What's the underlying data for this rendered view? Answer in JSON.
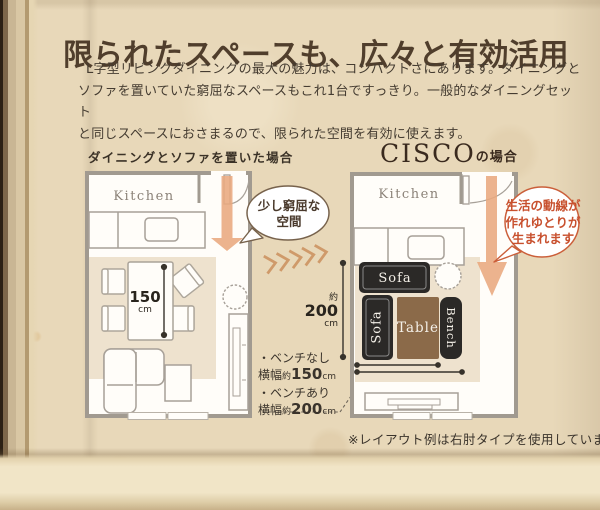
{
  "page": {
    "title": "限られたスペースも、広々と有効活用",
    "intro_lines": [
      "L字型リビングダイニングの最大の魅力は、コンパクトさにあります。ダイニングと",
      "ソファを置いていた窮屈なスペースもこれ1台ですっきり。一般的なダイニングセット",
      "と同じスペースにおさまるので、限られた空間を有効に使えます。"
    ],
    "footnote": "※レイアウト例は右肘タイプを使用しています。"
  },
  "before_plan": {
    "label": "ダイニングとソファを置いた場合",
    "kitchen_label": "Kitchen",
    "bubble_lines": [
      "少し窮屈な",
      "空間"
    ],
    "table_width": {
      "value": "150",
      "unit": "cm"
    }
  },
  "after_plan": {
    "brand": "CISCO",
    "brand_suffix": "の場合",
    "kitchen_label": "Kitchen",
    "bubble_lines": [
      "生活の動線が",
      "作れゆとりが",
      "生まれます"
    ],
    "furniture_labels": {
      "sofa_top": "Sofa",
      "sofa_side": "Sofa",
      "table": "Table",
      "bench": "Bench"
    }
  },
  "dimensions": {
    "depth": {
      "approx": "約",
      "value": "200",
      "unit": "cm"
    },
    "width_notes": [
      {
        "title": "・ベンチなし",
        "prefix": "横幅",
        "approx": "約",
        "value": "150",
        "unit": "cm"
      },
      {
        "title": "・ベンチあり",
        "prefix": "横幅",
        "approx": "約",
        "value": "200",
        "unit": "cm"
      }
    ]
  },
  "colors": {
    "paper": "#e8d8b9",
    "title_text": "#503e2c",
    "body_text": "#453c31",
    "wall_gray": "#a19a90",
    "rug_beige": "#eee2ce",
    "arrow_salmon": "#e9a87e",
    "chevron_tan": "#cf9a6a",
    "dark_furniture": "#2b2927",
    "table_brown": "#8b6a49",
    "bubble_before_border": "#77624c",
    "bubble_after_accent": "#cb5f3a",
    "measure_dark": "#37322b"
  }
}
